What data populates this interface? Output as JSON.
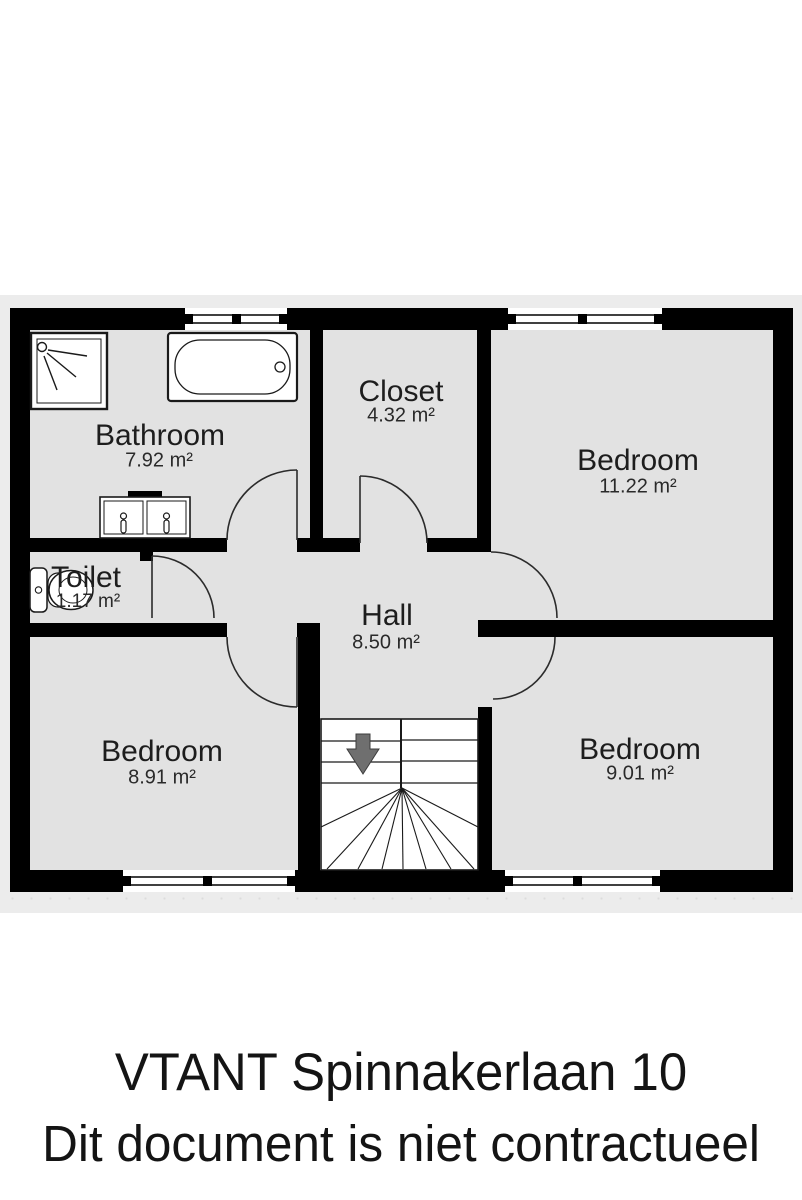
{
  "floorplan": {
    "title": "first-floor plan",
    "colors": {
      "wall": "#000000",
      "room_fill": "#e2e2e2",
      "canvas": "#ececec",
      "fixture_fill": "#ffffff",
      "arrow": "#6f6f6f"
    },
    "rooms": [
      {
        "name": "Bathroom",
        "area": "7.92 m²"
      },
      {
        "name": "Closet",
        "area": "4.32 m²"
      },
      {
        "name": "Bedroom",
        "area": "11.22 m²"
      },
      {
        "name": "Toilet",
        "area": "1.17 m²"
      },
      {
        "name": "Hall",
        "area": "8.50 m²"
      },
      {
        "name": "Bedroom",
        "area": "8.91 m²"
      },
      {
        "name": "Bedroom",
        "area": "9.01 m²"
      }
    ],
    "fixtures": [
      "shower-icon",
      "bathtub-icon",
      "double-sink-icon",
      "toilet-icon",
      "staircase-icon",
      "stairs-down-arrow-icon"
    ],
    "window_count": 4,
    "door_count": 6
  },
  "footer": {
    "line1": "VTANT Spinnakerlaan 10",
    "line2": "Dit document is niet contractueel"
  }
}
